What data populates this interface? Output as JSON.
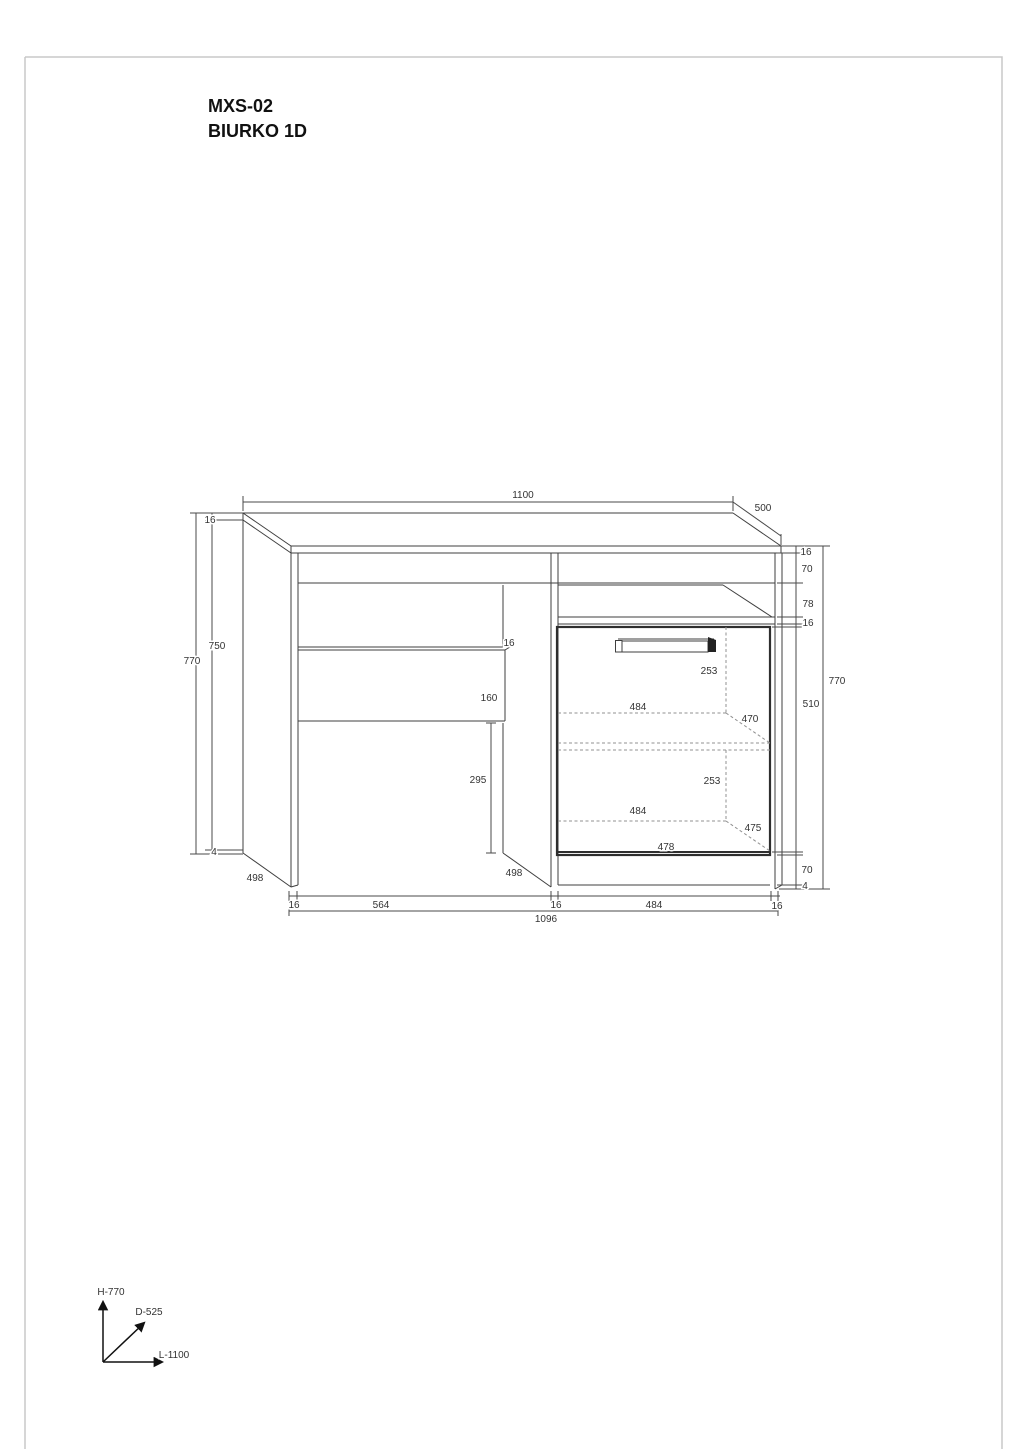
{
  "title": {
    "line1": "MXS-02",
    "line2": "BIURKO 1D"
  },
  "axis_legend": {
    "height": "H-770",
    "depth": "D-525",
    "length": "L-1100"
  },
  "drawing_colors": {
    "line": "#3f3f3f",
    "hidden_line": "#909090",
    "sheet_border": "#c8c8c8",
    "text": "#333333"
  },
  "dimension_labels": [
    {
      "id": "top-length",
      "text": "1100",
      "x": 523,
      "y": 495
    },
    {
      "id": "top-depth",
      "text": "500",
      "x": 763,
      "y": 508
    },
    {
      "id": "left-top-thickness",
      "text": "16",
      "x": 210,
      "y": 520
    },
    {
      "id": "left-overall-height",
      "text": "770",
      "x": 192,
      "y": 661
    },
    {
      "id": "left-side-height",
      "text": "750",
      "x": 217,
      "y": 646
    },
    {
      "id": "left-bottom-gap",
      "text": "4",
      "x": 214,
      "y": 852
    },
    {
      "id": "left-panel-depth",
      "text": "498",
      "x": 255,
      "y": 878
    },
    {
      "id": "right-top-thickness",
      "text": "16",
      "x": 806,
      "y": 552
    },
    {
      "id": "right-rail",
      "text": "70",
      "x": 807,
      "y": 569
    },
    {
      "id": "right-niche",
      "text": "78",
      "x": 808,
      "y": 604
    },
    {
      "id": "right-shelf-thk",
      "text": "16",
      "x": 808,
      "y": 623
    },
    {
      "id": "right-overall-height",
      "text": "770",
      "x": 837,
      "y": 681
    },
    {
      "id": "right-door-interior",
      "text": "510",
      "x": 811,
      "y": 704
    },
    {
      "id": "right-plinth",
      "text": "70",
      "x": 807,
      "y": 870
    },
    {
      "id": "right-bottom-gap",
      "text": "4",
      "x": 805,
      "y": 886
    },
    {
      "id": "drawer-front-thk",
      "text": "16",
      "x": 509,
      "y": 643
    },
    {
      "id": "drawer-height",
      "text": "160",
      "x": 489,
      "y": 698
    },
    {
      "id": "kneehole-height",
      "text": "295",
      "x": 478,
      "y": 780
    },
    {
      "id": "divider-depth",
      "text": "498",
      "x": 514,
      "y": 873
    },
    {
      "id": "shelf-space-upper",
      "text": "253",
      "x": 709,
      "y": 671
    },
    {
      "id": "shelf-width-upper",
      "text": "484",
      "x": 638,
      "y": 707
    },
    {
      "id": "shelf-depth-upper",
      "text": "470",
      "x": 750,
      "y": 719
    },
    {
      "id": "shelf-space-lower",
      "text": "253",
      "x": 712,
      "y": 781
    },
    {
      "id": "shelf-width-lower",
      "text": "484",
      "x": 638,
      "y": 811
    },
    {
      "id": "shelf-depth-lower",
      "text": "475",
      "x": 753,
      "y": 828
    },
    {
      "id": "door-width",
      "text": "478",
      "x": 666,
      "y": 847
    },
    {
      "id": "bottom-left-panel",
      "text": "16",
      "x": 294,
      "y": 905
    },
    {
      "id": "bottom-kneehole",
      "text": "564",
      "x": 381,
      "y": 905
    },
    {
      "id": "bottom-divider",
      "text": "16",
      "x": 556,
      "y": 905
    },
    {
      "id": "bottom-cabinet",
      "text": "484",
      "x": 654,
      "y": 905
    },
    {
      "id": "bottom-right-panel",
      "text": "16",
      "x": 777,
      "y": 906
    },
    {
      "id": "bottom-overall",
      "text": "1096",
      "x": 546,
      "y": 919
    }
  ]
}
